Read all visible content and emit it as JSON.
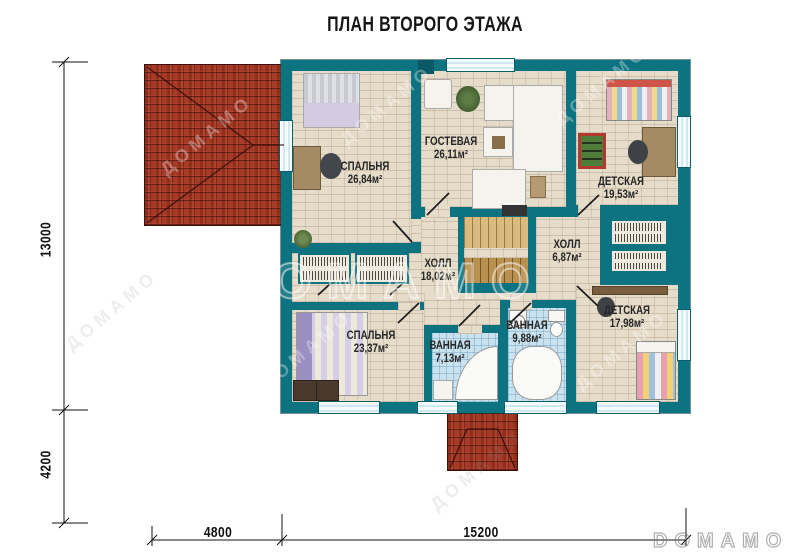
{
  "title": "ПЛАН ВТОРОГО ЭТАЖА",
  "watermark": {
    "center": "ДОМАМО",
    "diagonal": "ДОМАМО",
    "corner_logo": "DOMAMO"
  },
  "dimensions": {
    "left_upper": "13000",
    "left_lower": "4200",
    "bottom_left": "4800",
    "bottom_right": "15200"
  },
  "rooms": [
    {
      "id": "bedroom-top-left",
      "name": "СПАЛЬНЯ",
      "area": "26,84м²"
    },
    {
      "id": "guest-room",
      "name": "ГОСТЕВАЯ",
      "area": "26,11м²"
    },
    {
      "id": "child-top-right",
      "name": "ДЕТСКАЯ",
      "area": "19,53м²"
    },
    {
      "id": "hall-main",
      "name": "ХОЛЛ",
      "area": "18,02м²"
    },
    {
      "id": "hall-small",
      "name": "ХОЛЛ",
      "area": "6,87м²"
    },
    {
      "id": "child-bottom-right",
      "name": "ДЕТСКАЯ",
      "area": "17,98м²"
    },
    {
      "id": "bedroom-bottom-left",
      "name": "СПАЛЬНЯ",
      "area": "23,37м²"
    },
    {
      "id": "bathroom-small",
      "name": "ВАННАЯ",
      "area": "7,13м²"
    },
    {
      "id": "bathroom-large",
      "name": "ВАННАЯ",
      "area": "9,88м²"
    }
  ],
  "colors": {
    "wall": "#0e7380",
    "wall-dark": "#0a5a66",
    "floor": "#e6dcca",
    "tile": "#c9e2ee",
    "roof": "#a43a27",
    "wood1": "#d9bb80",
    "wood2": "#b8904f",
    "glass": "#e8f5fa",
    "ink": "#222222"
  }
}
